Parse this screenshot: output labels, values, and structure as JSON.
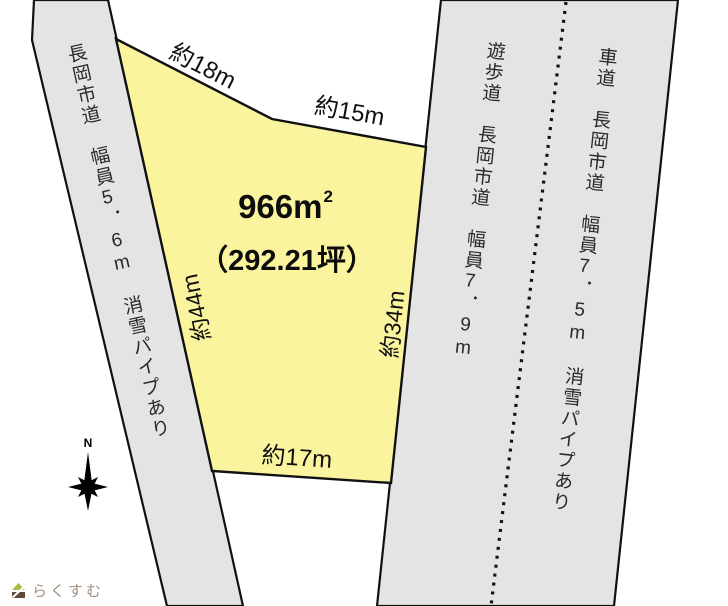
{
  "map": {
    "plot": {
      "area_text": "966m",
      "area_exponent": "2",
      "tsubo_text": "（292.21坪）",
      "edge_top_left": "約18m",
      "edge_top_right": "約15m",
      "edge_left": "約44m",
      "edge_right": "約34m",
      "edge_bottom": "約17m"
    },
    "roads": {
      "left_label": "長岡市道　幅員5．6m　消雪パイプあり",
      "walkway_label": "遊歩道　長岡市道　幅員7．9m",
      "roadway_label": "車道　長岡市道　幅員7．5m　消雪パイプあり"
    },
    "compass": {
      "north_label": "N"
    },
    "branding": {
      "logo_text": "らくすむ"
    },
    "colors": {
      "plot_fill": "#FBF49E",
      "road_fill": "#E4E4E4",
      "outline": "#111111",
      "logo_green": "#A6BE44",
      "logo_brown": "#5D4B3C",
      "logo_text_color": "#A28E7E"
    }
  }
}
